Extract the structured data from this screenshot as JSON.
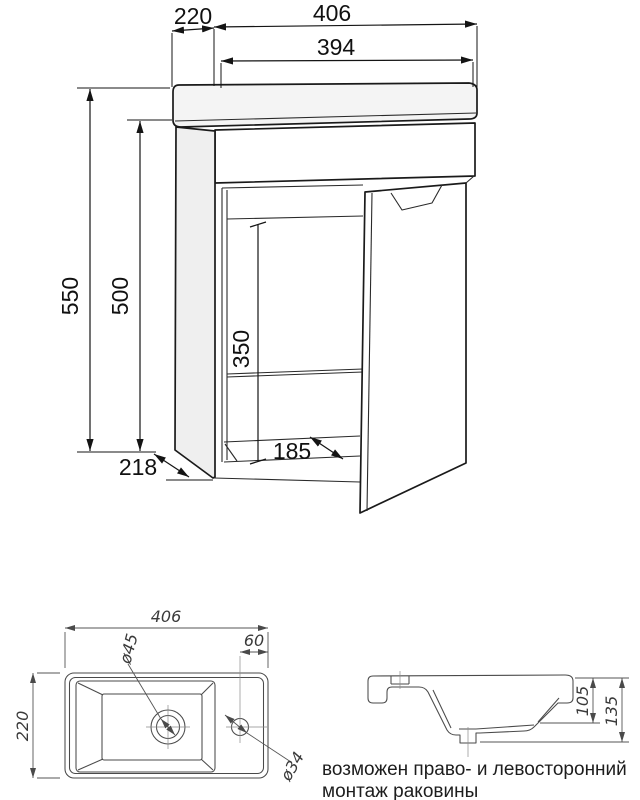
{
  "front_view": {
    "dims": {
      "depth_top": "220",
      "width_overall": "406",
      "width_inner": "394",
      "height_overall": "550",
      "cabinet_height": "500",
      "interior_height": "350",
      "interior_depth": "185",
      "depth_bottom": "218"
    }
  },
  "top_view": {
    "dims": {
      "width": "406",
      "depth": "220",
      "faucet_offset": "60",
      "drain_diameter": "ø45",
      "faucet_diameter": "ø34"
    }
  },
  "side_view": {
    "dims": {
      "basin_depth": "105",
      "total_height": "135"
    }
  },
  "note": {
    "line1": "возможен право- и левосторонний",
    "line2": "монтаж раковины"
  },
  "colors": {
    "background": "#ffffff",
    "line_dark": "#1a1a1a",
    "line_light": "#4a4a4a",
    "panel_fill": "#f4f4f4"
  }
}
